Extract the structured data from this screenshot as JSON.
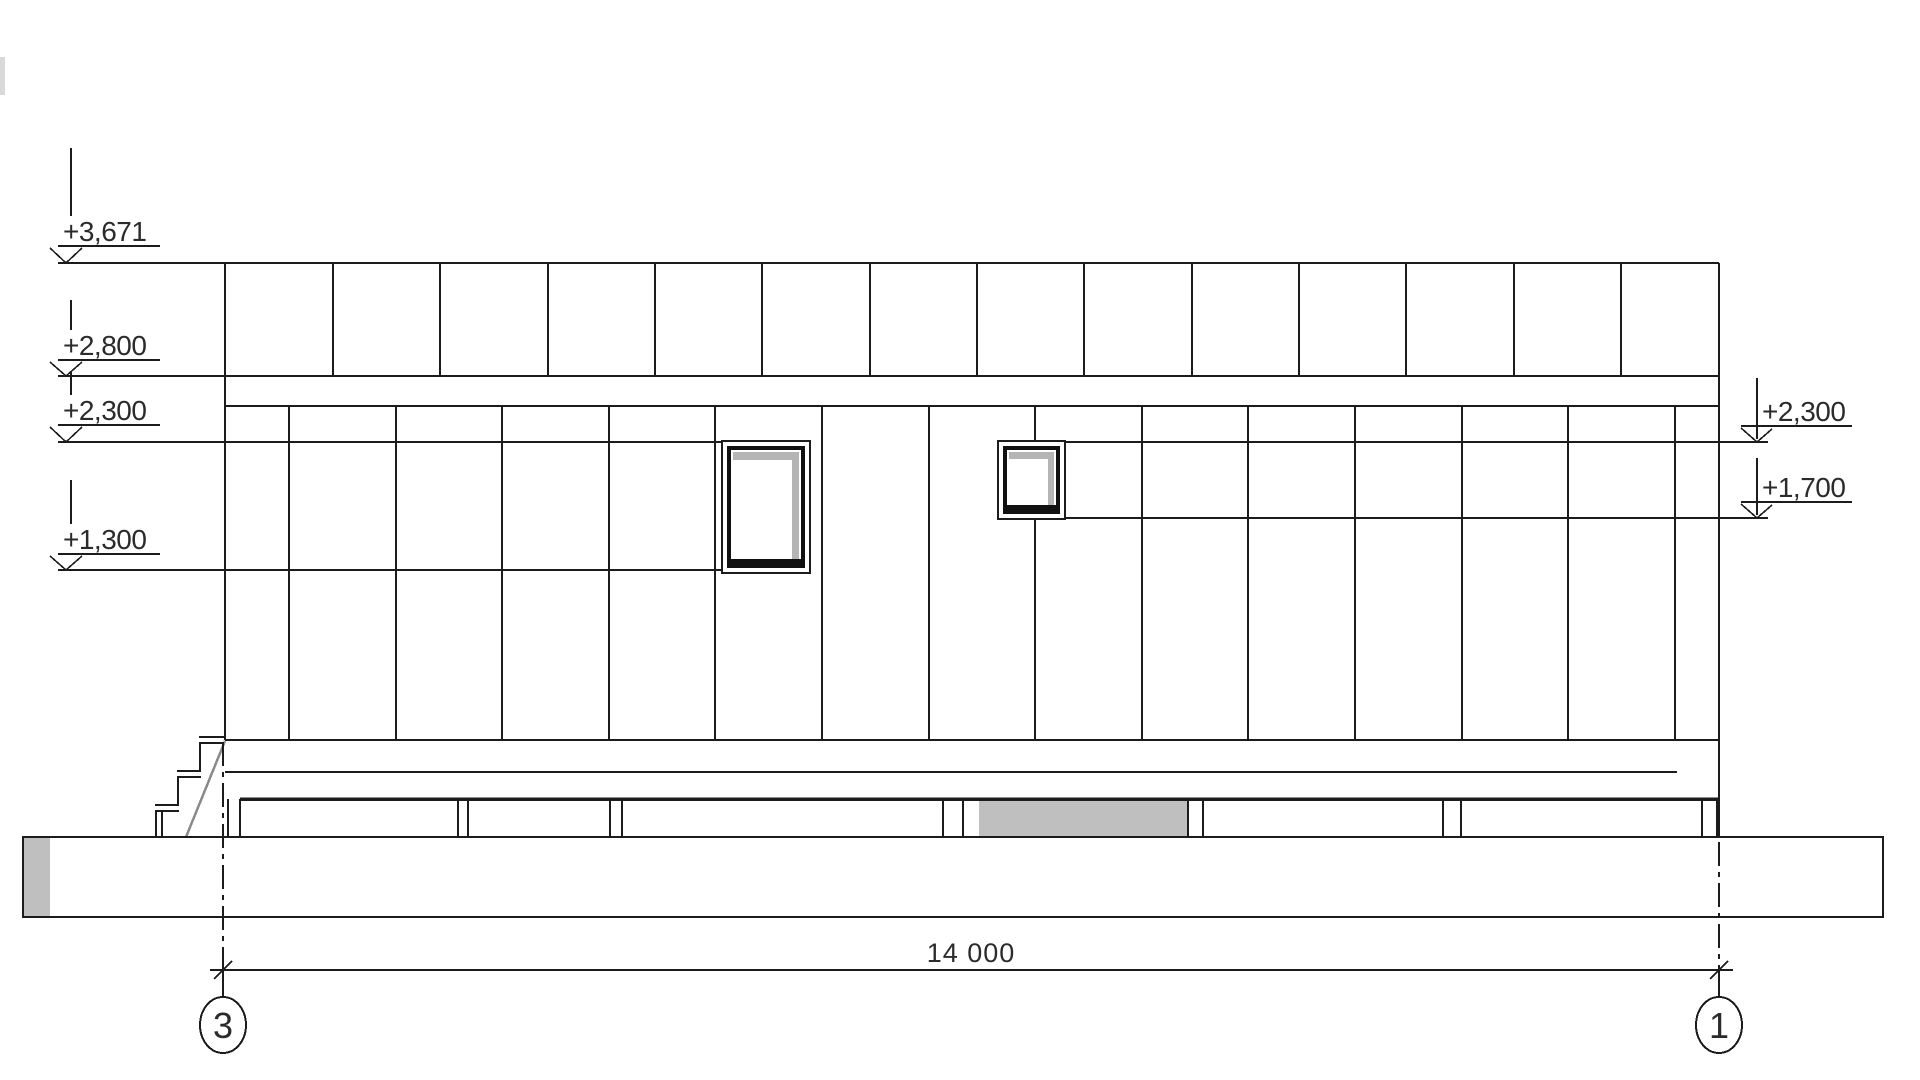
{
  "drawing": {
    "type": "architectural-elevation",
    "left_levels": [
      {
        "id": "level-3671",
        "label": "+3,671"
      },
      {
        "id": "level-2800",
        "label": "+2,800"
      },
      {
        "id": "level-2300-left",
        "label": "+2,300"
      },
      {
        "id": "level-1300",
        "label": "+1,300"
      }
    ],
    "right_levels": [
      {
        "id": "level-2300-right",
        "label": "+2,300"
      },
      {
        "id": "level-1700",
        "label": "+1,700"
      }
    ],
    "dimension": {
      "value": "14 000"
    },
    "axes": [
      {
        "id": "axis-3",
        "label": "3"
      },
      {
        "id": "axis-1",
        "label": "1"
      }
    ],
    "colors": {
      "background": "#ffffff",
      "line": "#1c1c1c",
      "text": "#2b2b2b",
      "shading": "#bfbfbf",
      "window_shadow": "#b5b5b5",
      "stringer": "#8a8a8a",
      "edge_artifact": "#d9d9d9"
    }
  }
}
